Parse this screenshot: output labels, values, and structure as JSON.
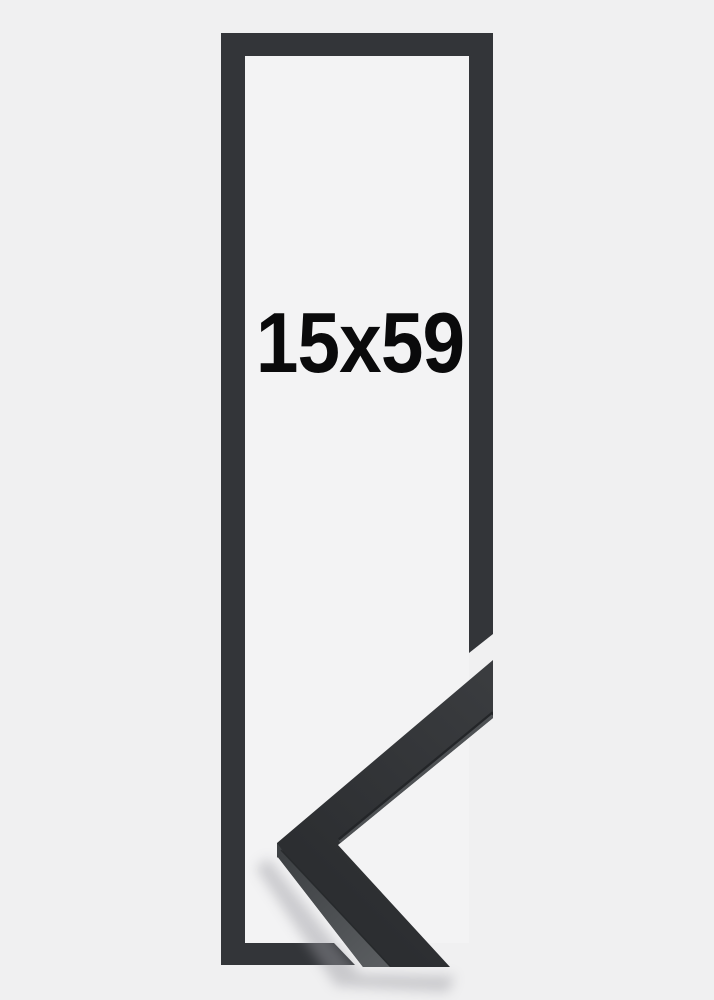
{
  "product": {
    "size_label": "15x59"
  },
  "colors": {
    "background": "#f0f0f1",
    "inner_background": "#f3f3f4",
    "frame": "#333539",
    "molding_top_light": "#3b3d40",
    "molding_top_dark": "#2c2e31",
    "molding_side_light": "#5b5e61",
    "molding_side_dark": "#3e4144",
    "molding_edge_dark": "#232528",
    "molding_edge_light": "#4e5154",
    "molding_seam": "#26282b",
    "label_text": "#0a0a0b",
    "shadow_color": "#9a9aa0"
  }
}
